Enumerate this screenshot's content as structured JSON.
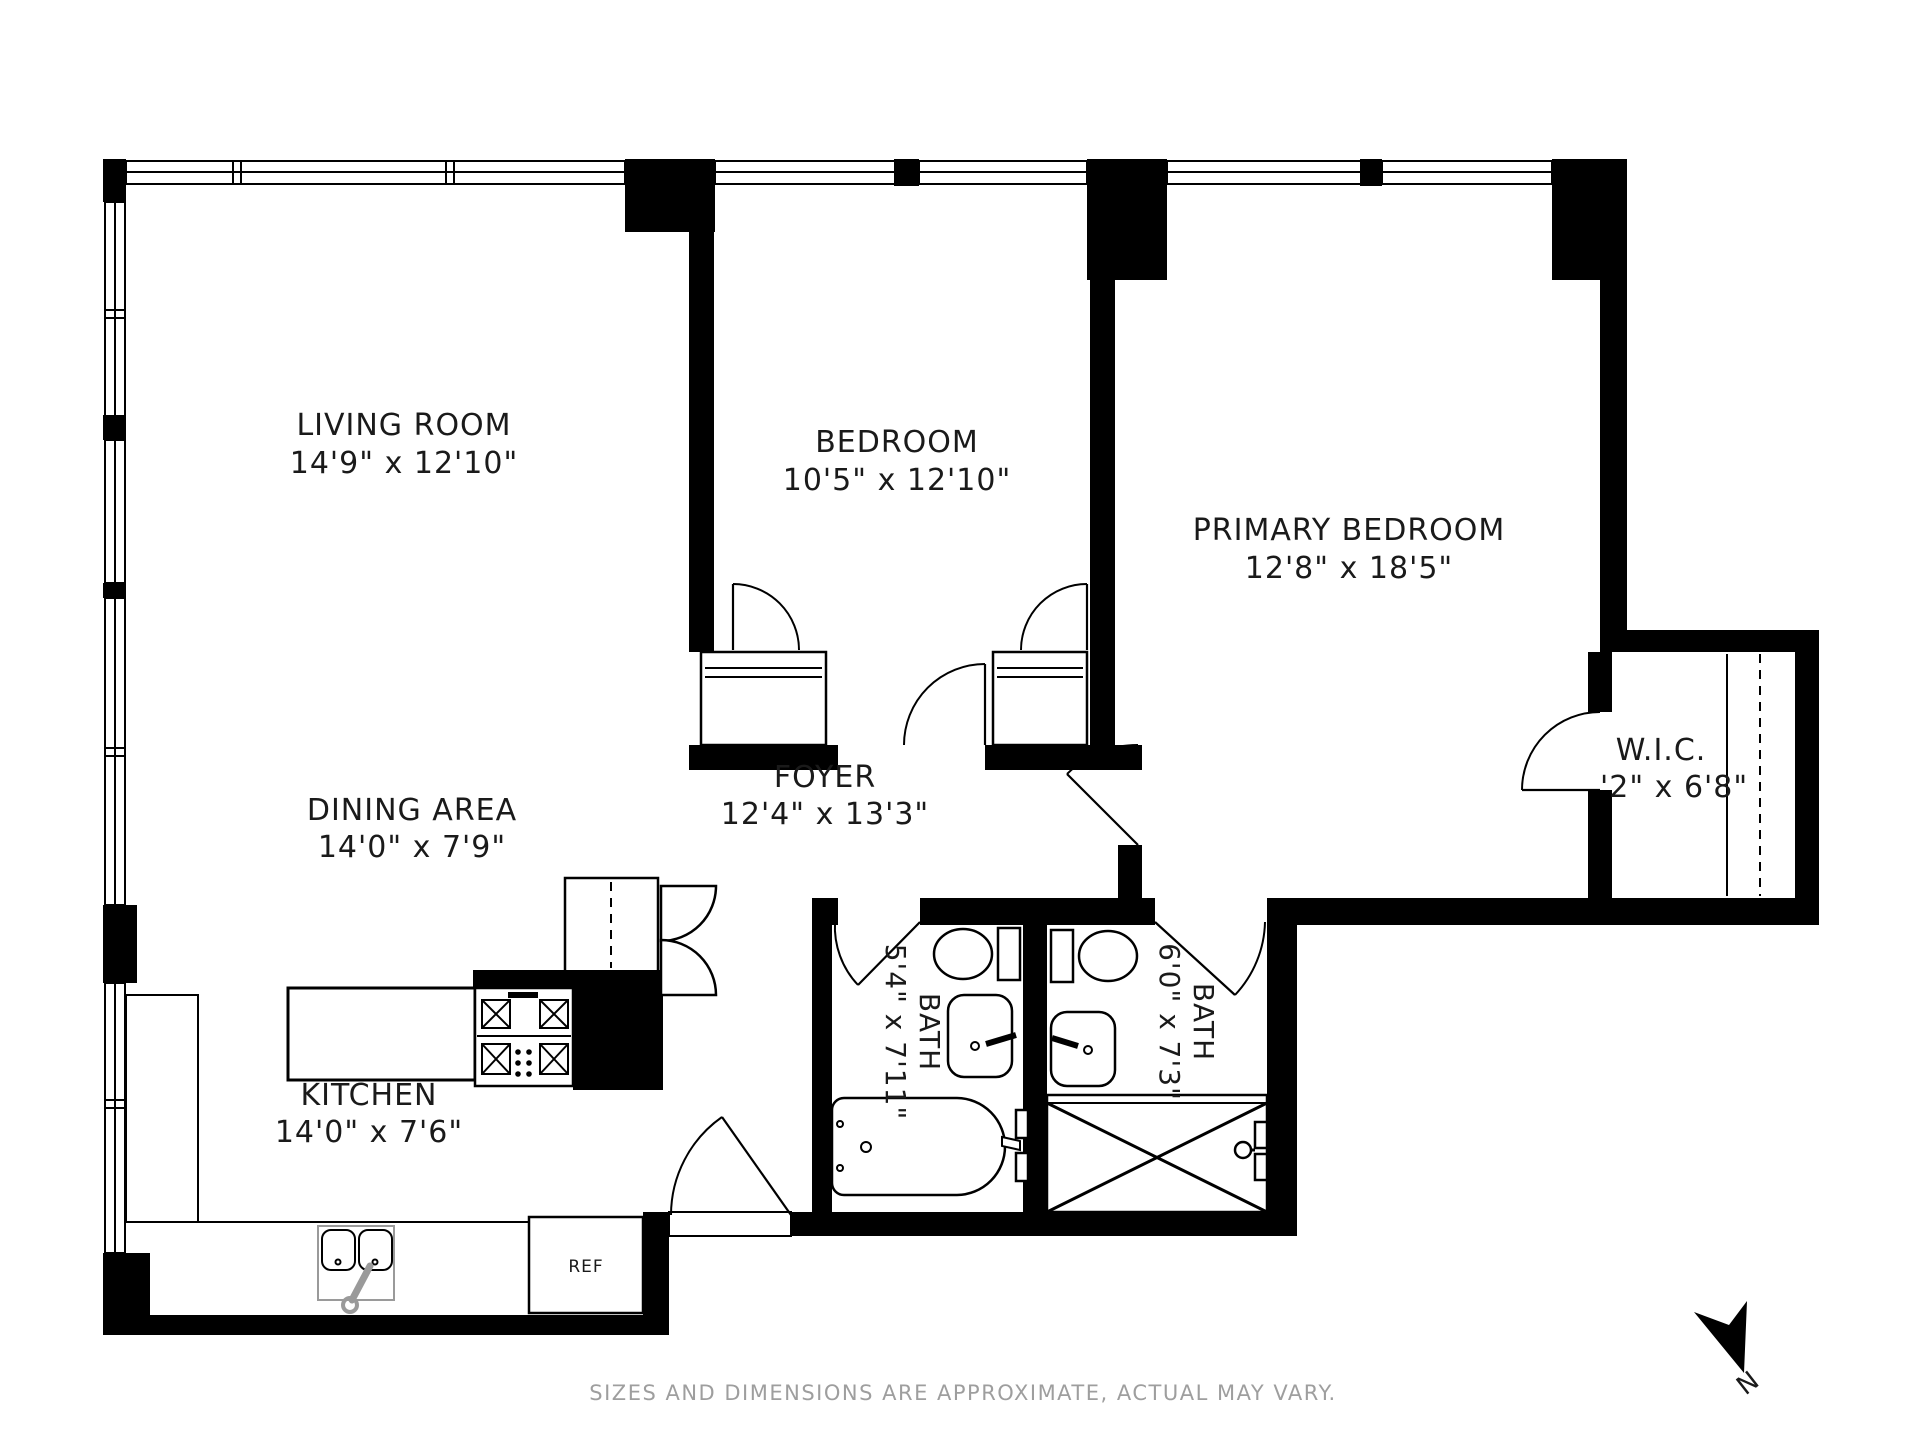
{
  "colors": {
    "wall": "#000000",
    "bg": "#ffffff",
    "gray": "#9e9e9e",
    "faucet": "#9a9a9a",
    "ink": "#1a1a1a"
  },
  "rooms": {
    "living": {
      "name": "LIVING ROOM",
      "dims": "14'9\" x 12'10\""
    },
    "bedroom": {
      "name": "BEDROOM",
      "dims": "10'5\" x 12'10\""
    },
    "primary": {
      "name": "PRIMARY BEDROOM",
      "dims": "12'8\" x 18'5\""
    },
    "dining": {
      "name": "DINING AREA",
      "dims": "14'0\" x 7'9\""
    },
    "foyer": {
      "name": "FOYER",
      "dims": "12'4\" x 13'3\""
    },
    "kitchen": {
      "name": "KITCHEN",
      "dims": "14'0\" x 7'6\""
    },
    "wic": {
      "name": "W.I.C.",
      "dims": "'2\" x 6'8\""
    },
    "bath1": {
      "name": "BATH",
      "dims": "5'4\" x 7'11\""
    },
    "bath2": {
      "name": "BATH",
      "dims": "6'0\" x 7'3\""
    }
  },
  "labels": {
    "refrigerator": "REF",
    "compass_north": "N"
  },
  "disclaimer": "SIZES AND DIMENSIONS ARE APPROXIMATE, ACTUAL MAY VARY."
}
